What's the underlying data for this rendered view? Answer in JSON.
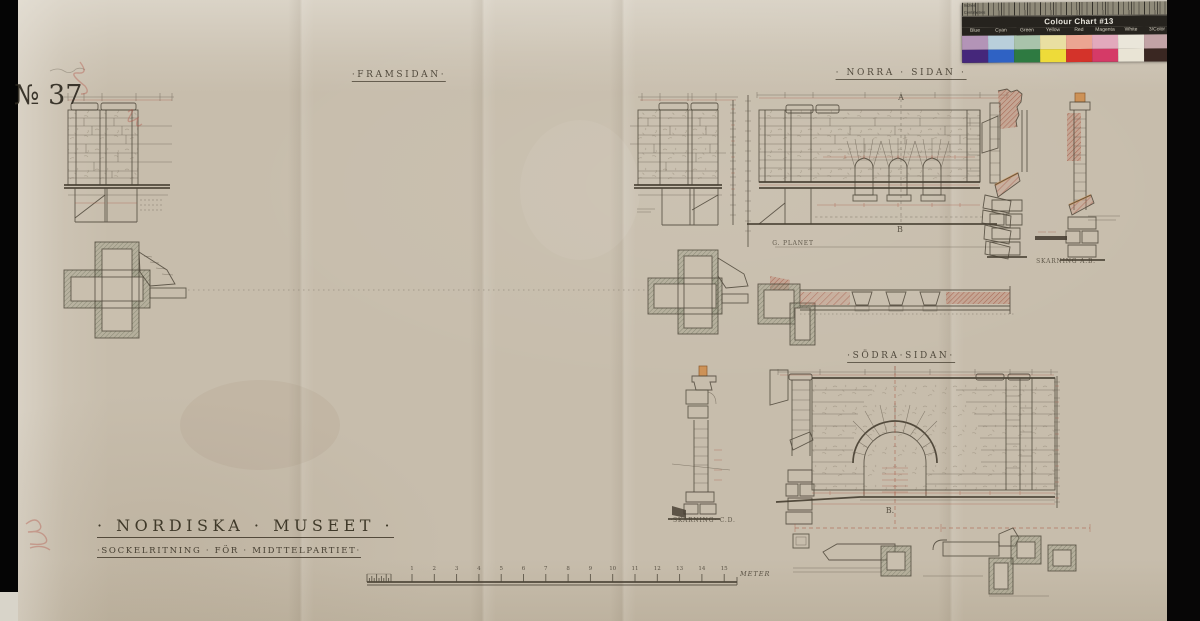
{
  "stamp": {
    "number": "№ 37"
  },
  "view_labels": {
    "framsidan": "·FRAMSIDAN·",
    "norra_sidan": "· NORRA · SIDAN ·",
    "sodra_sidan": "·SÖDRA·SIDAN·"
  },
  "title_block": {
    "main": "· NORDISKA · MUSEET ·",
    "sub": "·SOCKELRITNING · FÖR · MIDTTELPARTIET·"
  },
  "annotations": {
    "skarning_ab": "SKÄRNING A.B.",
    "skarning_cd": "·SKÄRNING· C.D.",
    "planet": "G. PLANET",
    "marker_a": "A",
    "marker_b_north": "B",
    "marker_b_south": "B."
  },
  "scale_bar": {
    "ticks": [
      "1",
      "2",
      "3",
      "4",
      "5",
      "6",
      "7",
      "8",
      "9",
      "10",
      "11",
      "12",
      "13",
      "14",
      "15"
    ],
    "unit": "METER"
  },
  "colour_chart": {
    "title": "Colour Chart #13",
    "ruler_labels": {
      "top": "Inches",
      "bottom": "Centimetres"
    },
    "columns": [
      {
        "label": "Blue",
        "light": "#b394b7",
        "dark": "#45277b"
      },
      {
        "label": "Cyan",
        "light": "#b9cfdb",
        "dark": "#2f62c4"
      },
      {
        "label": "Green",
        "light": "#a9c3ab",
        "dark": "#2e7a41"
      },
      {
        "label": "Yellow",
        "light": "#e9dfa2",
        "dark": "#eedb39"
      },
      {
        "label": "Red",
        "light": "#eba592",
        "dark": "#d4332a"
      },
      {
        "label": "Magenta",
        "light": "#e2a9bc",
        "dark": "#d53a67"
      },
      {
        "label": "White",
        "light": "#eae6da",
        "dark": "#e9e4d5"
      },
      {
        "label": "3/Color",
        "light": "#c2a3a6",
        "dark": "#3a2722"
      },
      {
        "label": "Black",
        "light": "#8e8a8b",
        "dark": "#191619"
      }
    ]
  },
  "colors": {
    "paper": "#c7bdac",
    "ink": "#4e463a",
    "dimension_red": "#a8523d",
    "hatch_pink": "#b06a55",
    "wood_orange": "#cd9257"
  }
}
